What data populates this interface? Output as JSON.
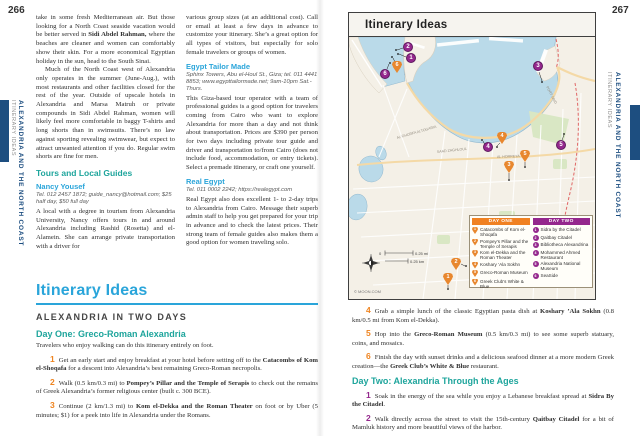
{
  "colors": {
    "accent_blue": "#2aa5da",
    "teal": "#1ea59c",
    "orange": "#ef8420",
    "purple": "#94278d",
    "navy": "#1d4e80",
    "map_sea": "#badae9",
    "map_land": "#f4f0e7",
    "map_park": "#d9e7c4"
  },
  "left_page": {
    "page_number": "266",
    "sidebar": {
      "title": "ALEXANDRIA AND THE NORTH COAST",
      "subtitle": "ITINERARY IDEAS"
    },
    "col1": {
      "para1": {
        "pre": "take in some fresh Mediterranean air. But those looking for a North Coast seaside vacation would be better served in ",
        "bold": "Sidi Abdel Rahman,",
        "post": " where the beaches are cleaner and women can comfortably show their skin. For a more economical Egyptian holiday in the sun, head to the South Sinai."
      },
      "para2": "Much of the North Coast west of Alexandria only operates in the summer (June-Aug.), with most restaurants and other facilities closed for the rest of the year. Outside of upscale hotels in Alexandria and Marsa Matruh or private compounds in Sidi Abdel Rahman, women will likely feel more comfortable in baggy T-shirts and long shorts than in swimsuits. There’s no law against sporting revealing swimwear, but expect to attract unwanted attention if you do. Regular swim shorts are fine for men.",
      "heading": "Tours and Local Guides",
      "sub_heading": "Nancy Yousef",
      "contact": "Tel. 012 2457 1872; guide_nancy@hotmail.com; $25 half day, $50 full day",
      "para3": "A local with a degree in tourism from Alexandria University, Nancy offers tours in and around Alexandria including Rashid (Rosetta) and el-Alamein. She can arrange private transportation with a driver for"
    },
    "col2": {
      "para1": "various group sizes (at an additional cost). Call or email at least a few days in advance to customize your itinerary. She’s a great option for all types of visitors, but especially for solo female travelers or groups of women.",
      "sub_heading1": "Egypt Tailor Made",
      "contact1": "Sphinx Towers, Abu el-Houl St., Giza; tel. 011 4441 8853; www.egypttailormade.net; 9am-10pm Sat.-Thurs.",
      "para2": "This Giza-based tour operator with a team of professional guides is a good option for travelers coming from Cairo who want to explore Alexandria for more than a day and not think about transportation. Prices are $390 per person for two days including private tour guide and driver and transportation to/from Cairo (does not include food, accommodation, or entry tickets). Select a premade itinerary, or craft one yourself.",
      "sub_heading2": "Real Egypt",
      "contact2": "Tel. 011 0002 2242; https://realegypt.com",
      "para3": "Real Egypt also does excellent 1- to 2-day trips to Alexandria from Cairo. Message their superb admin staff to help you get prepared for your trip in advance and to check the latest prices. Their strong team of female guides also makes them a good option for women traveling solo."
    },
    "itinerary": {
      "title": "Itinerary Ideas",
      "section": "ALEXANDRIA IN TWO DAYS",
      "day_one_heading": "Day One: Greco-Roman Alexandria",
      "intro": "Travelers who enjoy walking can do this itinerary entirely on foot.",
      "steps": [
        {
          "num": "1",
          "pre": "Get an early start and enjoy breakfast at your hotel before setting off to the ",
          "bold": "Catacombs of Kom el-Shoqafa",
          "post": " for a descent into Alexandria’s best remaining Greco-Roman necropolis."
        },
        {
          "num": "2",
          "pre": "Walk (0.5 km/0.3 mi) to ",
          "bold": "Pompey’s Pillar and the Temple of Serapis",
          "post": " to check out the remains of Greek Alexandria’s former religious center (built c. 300 BCE)."
        },
        {
          "num": "3",
          "pre": "Continue (2 km/1.3 mi) to ",
          "bold": "Kom el-Dekka and the Roman Theater",
          "post": " on foot or by Uber (5 minutes; $1) for a peek into life in Alexandria under the Romans."
        }
      ]
    }
  },
  "right_page": {
    "page_number": "267",
    "sidebar": {
      "title": "ALEXANDRIA AND THE NORTH COAST",
      "subtitle": "ITINERARY IDEAS"
    },
    "map": {
      "title": "Itinerary Ideas",
      "credit": "© MOON.COM",
      "scale": {
        "zero": "0",
        "mi": "0.25 mi",
        "km": "0.25 km"
      },
      "street_labels": [
        "SAAD ZAGHLOUL",
        "AL GHORFA ALTOGARIA",
        "PORT SAID",
        "AL HORREYA"
      ],
      "legend": {
        "day_one": {
          "label": "DAY ONE",
          "items": [
            {
              "num": "1",
              "label": "Catacombs of Kom el-Shoqafa"
            },
            {
              "num": "2",
              "label": "Pompey’s Pillar and the Temple of Serapis"
            },
            {
              "num": "3",
              "label": "Kom el-Dekka and the Roman Theater"
            },
            {
              "num": "4",
              "label": "Koshary ’Ala Sokhn"
            },
            {
              "num": "5",
              "label": "Greco-Roman Museum"
            },
            {
              "num": "6",
              "label": "Greek Club’s White & Blue"
            }
          ]
        },
        "day_two": {
          "label": "DAY TWO",
          "items": [
            {
              "num": "1",
              "label": "Sidra by the Citadel"
            },
            {
              "num": "2",
              "label": "Qaitbay Citadel"
            },
            {
              "num": "3",
              "label": "Bibliotheca Alexandrina"
            },
            {
              "num": "4",
              "label": "Mohammed Ahmed Restaurant"
            },
            {
              "num": "5",
              "label": "Alexandria National Museum"
            },
            {
              "num": "6",
              "label": "SeaSide"
            }
          ]
        }
      },
      "markers": [
        {
          "day": "two",
          "num": "2"
        },
        {
          "day": "two",
          "num": "1"
        },
        {
          "day": "one",
          "num": "6"
        },
        {
          "day": "two",
          "num": "6"
        },
        {
          "day": "two",
          "num": "3"
        },
        {
          "day": "one",
          "num": "4"
        },
        {
          "day": "two",
          "num": "4"
        },
        {
          "day": "one",
          "num": "5"
        },
        {
          "day": "one",
          "num": "3"
        },
        {
          "day": "two",
          "num": "5"
        },
        {
          "day": "one",
          "num": "2"
        },
        {
          "day": "one",
          "num": "1"
        }
      ]
    },
    "itinerary": {
      "steps_day_one": [
        {
          "num": "4",
          "pre": "Grab a simple lunch of the classic Egyptian pasta dish at ",
          "bold": "Koshary ’Ala Sokhn",
          "post": " (0.8 km/0.5 mi from Kom el-Dekka)."
        },
        {
          "num": "5",
          "pre": "Hop into the ",
          "bold": "Greco-Roman Museum",
          "post": " (0.5 km/0.3 mi) to see some superb statuary, coins, and mosaics."
        },
        {
          "num": "6",
          "pre": "Finish the day with sunset drinks and a delicious seafood dinner at a more modern Greek creation—the ",
          "bold": "Greek Club’s White & Blue",
          "post": " restaurant."
        }
      ],
      "day_two_heading": "Day Two: Alexandria Through the Ages",
      "steps_day_two": [
        {
          "num": "1",
          "pre": "Soak in the energy of the sea while you enjoy a Lebanese breakfast spread at ",
          "bold": "Sidra By the Citadel",
          "post": "."
        },
        {
          "num": "2",
          "pre": "Walk directly across the street to visit the 15th-century ",
          "bold": "Qaitbay Citadel",
          "post": " for a bit of Mamluk history and more beautiful views of the harbor."
        }
      ]
    }
  }
}
